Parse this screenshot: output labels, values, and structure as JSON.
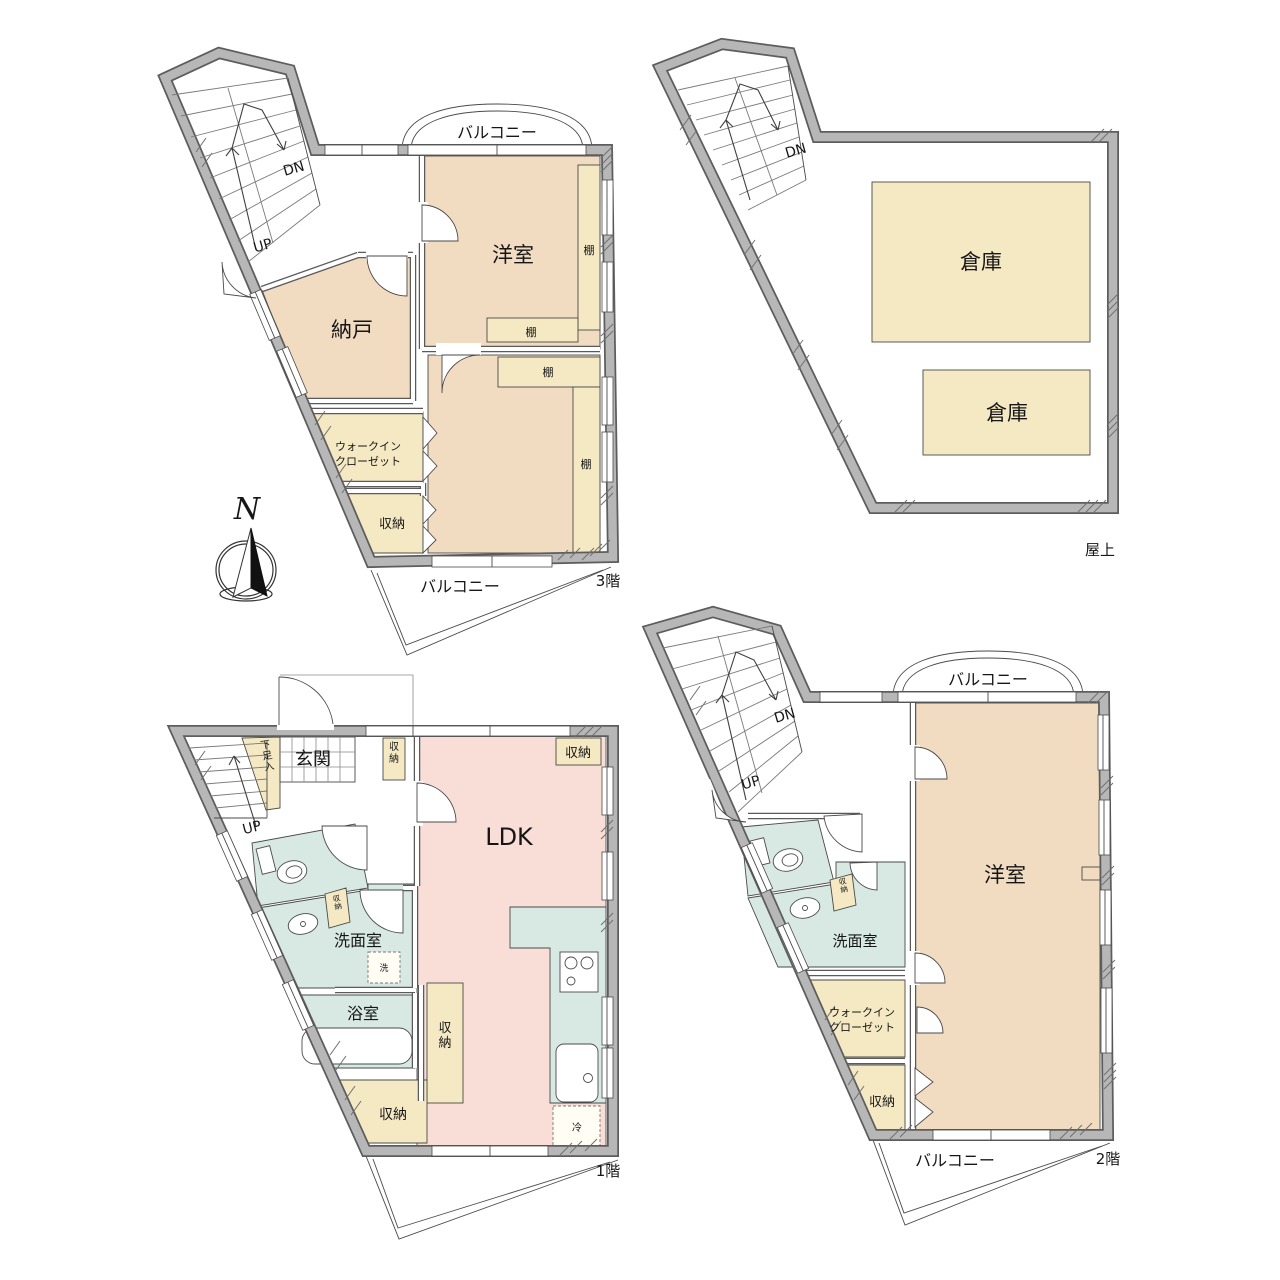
{
  "palette": {
    "wall_gray": "#b7b7b7",
    "wall_edge": "#5d5d5d",
    "room_beige": "#f2dcc1",
    "closet_cream": "#f5e9c4",
    "ldk_pink": "#f9ded7",
    "wet_teal": "#d7e9e2"
  },
  "compass": {
    "north": "N"
  },
  "floor3": {
    "label": "3階",
    "balcony_top": "バルコニー",
    "balcony_bottom": "バルコニー",
    "dn": "DN",
    "up": "UP",
    "room_upper": "洋室",
    "room_lower": "洋室",
    "nando": "納戸",
    "wic_line1": "ウォークイン",
    "wic_line2": "クローゼット",
    "storage": "収納",
    "shelf": "棚"
  },
  "roof": {
    "label": "屋上",
    "dn": "DN",
    "storage1": "倉庫",
    "storage2": "倉庫"
  },
  "floor1": {
    "label": "1階",
    "up": "UP",
    "entrance": "玄関",
    "shoe_box": "下足入",
    "storage_hall": "収納",
    "storage_top_right": "収納",
    "ldk": "LDK",
    "washroom": "洗面室",
    "washroom_storage": "収納",
    "washer": "洗",
    "bath": "浴室",
    "storage_mid": "収納",
    "storage_bottom": "収納",
    "fridge": "冷"
  },
  "floor2": {
    "label": "2階",
    "balcony_top": "バルコニー",
    "balcony_bottom": "バルコニー",
    "dn": "DN",
    "up": "UP",
    "room": "洋室",
    "washroom": "洗面室",
    "washroom_storage": "収納",
    "wic_line1": "ウォークイン",
    "wic_line2": "クローゼット",
    "storage": "収納"
  }
}
